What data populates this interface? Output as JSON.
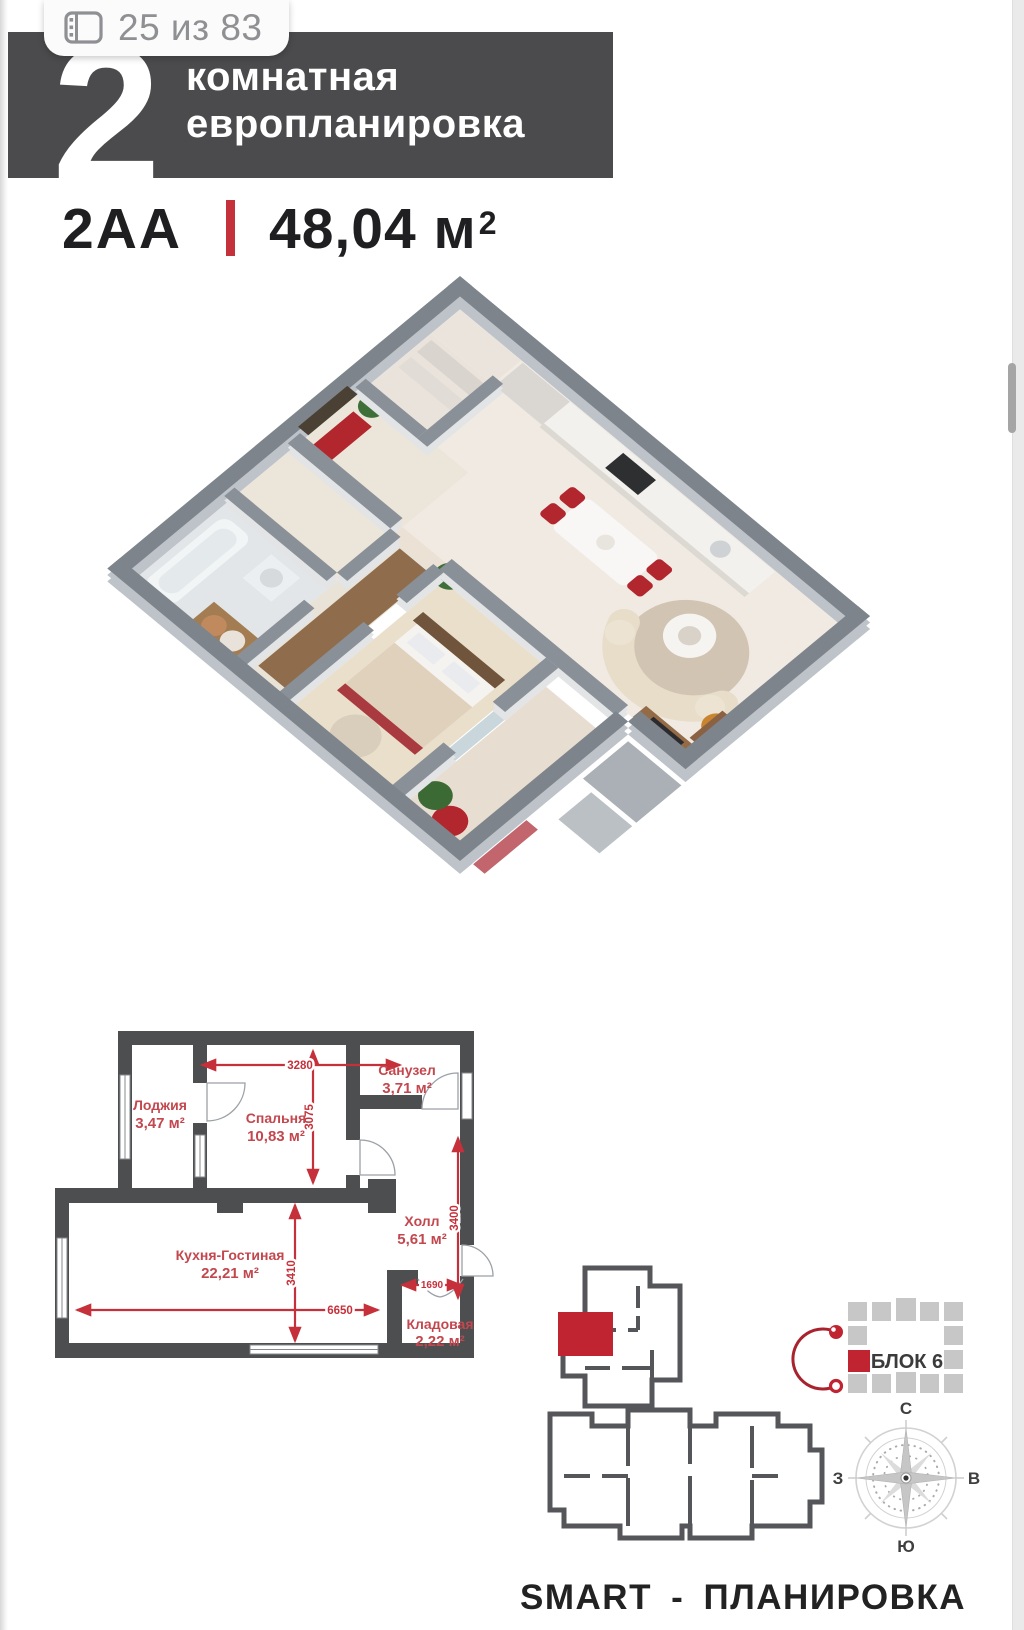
{
  "viewer": {
    "page_indicator": "25 из 83"
  },
  "banner": {
    "number": "2",
    "line1": "комнатная",
    "line2": "европланировка"
  },
  "title": {
    "code": "2АА",
    "area": "48,04 м",
    "area_sup": "2"
  },
  "plan2d": {
    "rooms": [
      {
        "name": "Лоджия",
        "area": "3,47 м²"
      },
      {
        "name": "Спальня",
        "area": "10,83 м²"
      },
      {
        "name": "Санузел",
        "area": "3,71 м²"
      },
      {
        "name": "Холл",
        "area": "5,61 м²"
      },
      {
        "name": "Кухня-Гостиная",
        "area": "22,21 м²"
      },
      {
        "name": "Кладовая",
        "area": "2,22 м²"
      }
    ],
    "dims": {
      "bedroom_width": "3280",
      "bedroom_height": "3075",
      "kitchen_height": "3410",
      "kitchen_width": "6650",
      "storage_width": "1690",
      "hall_height": "3400"
    }
  },
  "site": {
    "label": "БЛОК 6"
  },
  "compass": {
    "n": "С",
    "s": "Ю",
    "w": "З",
    "e": "В"
  },
  "footer": {
    "slogan": "SMART - ПЛАНИРОВКА"
  },
  "colors": {
    "accent_red": "#c5303a",
    "wall_gray": "#4d4e50",
    "unit_red": "#bf2430",
    "banner_gray": "#4b4b4d"
  }
}
